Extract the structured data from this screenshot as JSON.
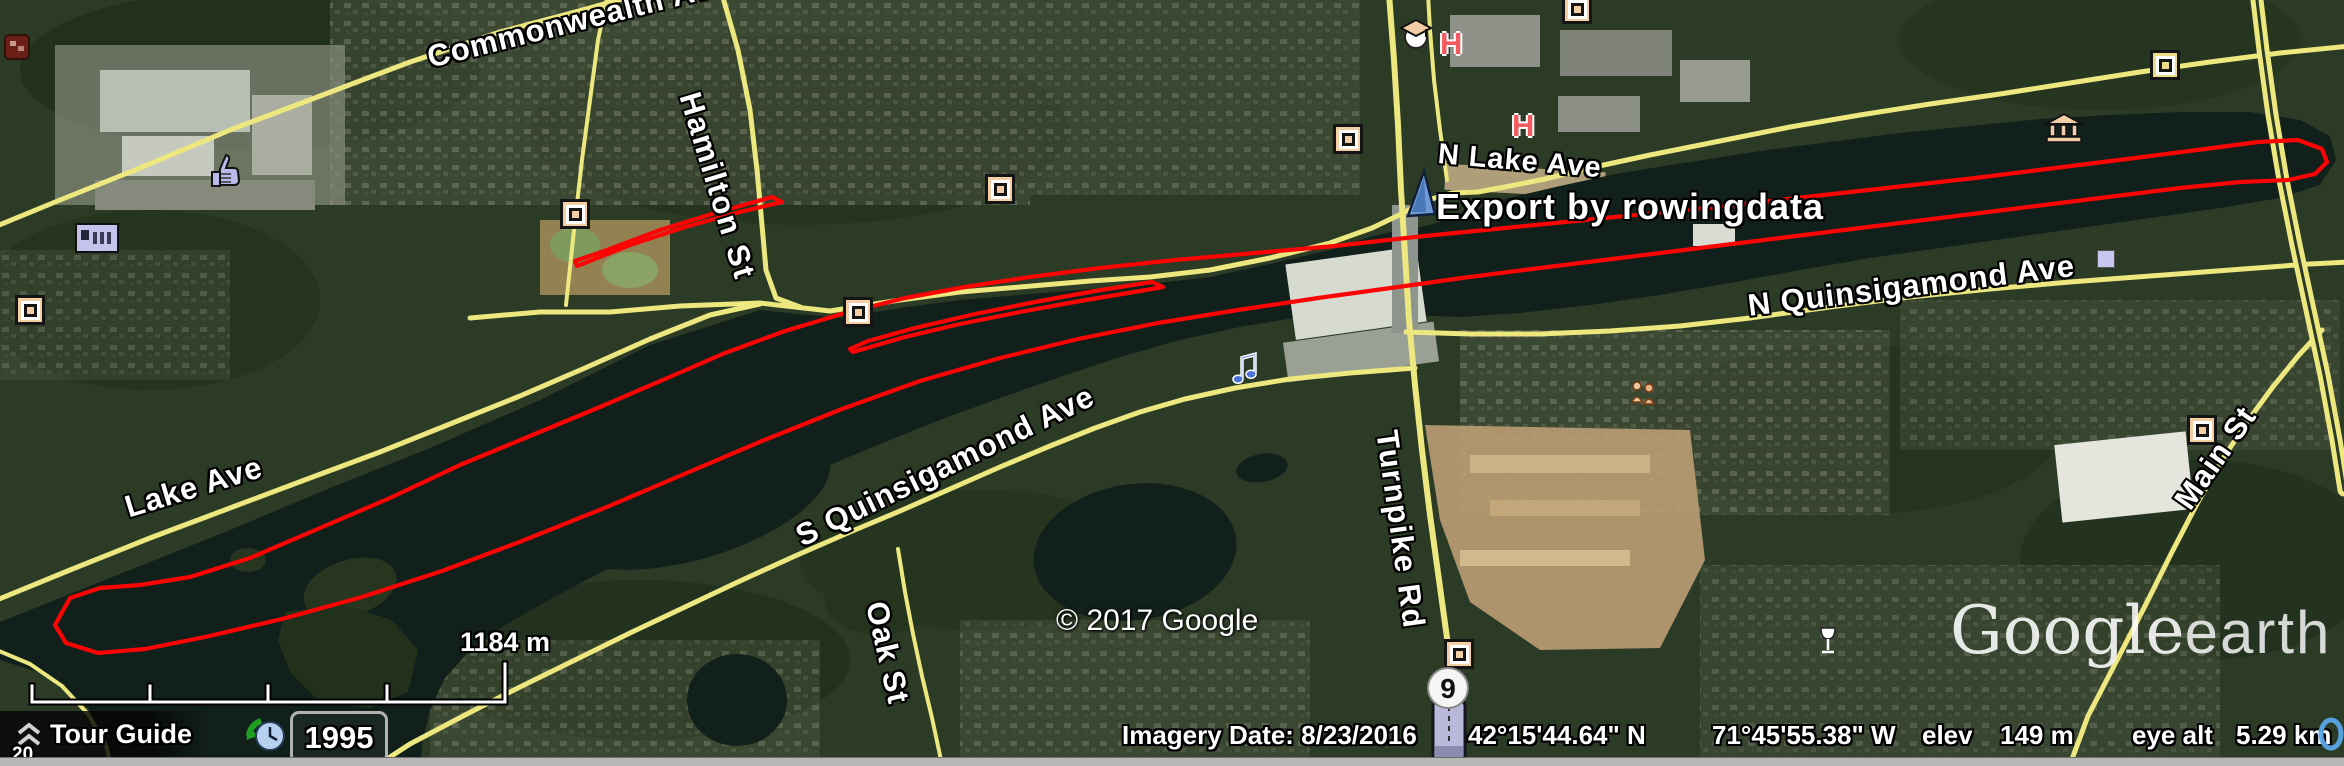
{
  "app_window": {
    "name": "Google Earth"
  },
  "overlay": {
    "track_label": "Export by rowingdata",
    "copyright": "© 2017 Google",
    "watermark_google": "Google",
    "watermark_earth": "earth",
    "scale_label": "1184 m",
    "partial_zoom_text": "20"
  },
  "road_labels": {
    "commonwealth": "Commonwealth Ave",
    "hamilton": "Hamilton St",
    "n_lake": "N Lake Ave",
    "n_quinsigamond": "N Quinsigamond Ave",
    "lake": "Lake Ave",
    "s_quinsigamond": "S Quinsigamond Ave",
    "oak": "Oak St",
    "turnpike": "Turnpike Rd",
    "main": "Main St"
  },
  "markers": {
    "route_shield_number": "9",
    "hospital_letter": "H",
    "icon_names": [
      "placemark-sail-icon",
      "photo-square-icon",
      "thumbs-up-icon",
      "sign-placard-icon",
      "graduation-cap-icon",
      "museum-icon",
      "music-note-icon",
      "wine-glass-icon",
      "people-icon",
      "road-ribbon-icon",
      "history-clock-icon",
      "streaming-indicator-icon"
    ]
  },
  "tour_guide": {
    "label": "Tour Guide",
    "year": "1995"
  },
  "status_bar": {
    "imagery_date": "Imagery Date: 8/23/2016",
    "latitude": "42°15'44.64\" N",
    "longitude": "71°45'55.38\" W",
    "elev_label": "elev",
    "elevation": "149 m",
    "eye_alt_label": "eye alt",
    "eye_altitude": "5.29 km"
  },
  "colors": {
    "gps_track": "#fb0404",
    "road_yellow": "#ece77f",
    "water": "#12201b",
    "label_text": "#ffffff",
    "poi_peach": "#f4cfa6"
  }
}
